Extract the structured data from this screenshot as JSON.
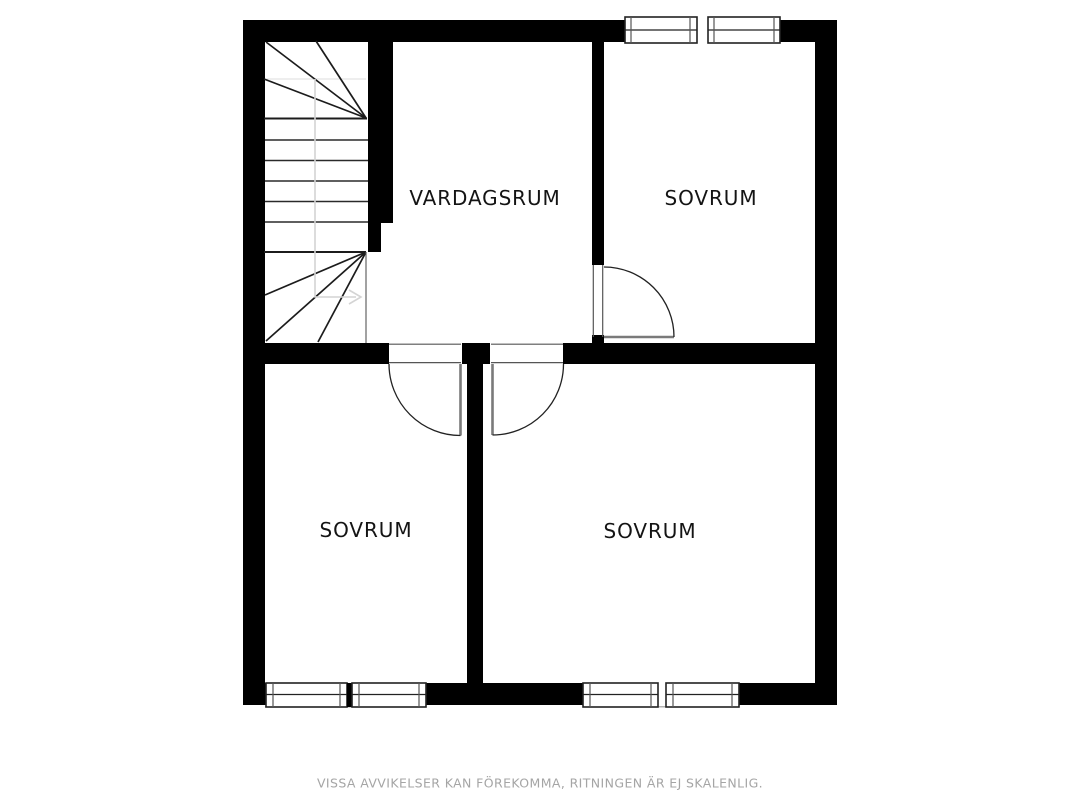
{
  "floorplan": {
    "rooms": {
      "vardagsrum": {
        "label": "VARDAGSRUM"
      },
      "sovrum_top": {
        "label": "SOVRUM"
      },
      "sovrum_bottom_left": {
        "label": "SOVRUM"
      },
      "sovrum_bottom_right": {
        "label": "SOVRUM"
      }
    },
    "disclaimer": "VISSA AVVIKELSER KAN FÖREKOMMA, RITNINGEN ÄR EJ SKALENLIG.",
    "features": {
      "stairs": "winder-staircase-with-walk-line-arrow",
      "doors": [
        "door-top-bedroom",
        "door-bottom-left-bedroom",
        "door-bottom-right-bedroom"
      ],
      "windows": [
        "top-bedroom-window-pair",
        "bottom-left-bedroom-window-pair",
        "bottom-right-bedroom-window-pair"
      ]
    },
    "colors": {
      "wall": "#000000",
      "line": "#1c1c1c",
      "tread": "#2a2a2a",
      "door-leaf": "#7a7a7a",
      "door-arc": "#222222",
      "frame": "#555555",
      "window-frame": "#222222",
      "window-sill": "#999999",
      "walk-line": "#d4d4d4",
      "guide": "#dddddd",
      "label": "#141414",
      "caption": "#a5a5a5",
      "bg": "#ffffff"
    }
  }
}
